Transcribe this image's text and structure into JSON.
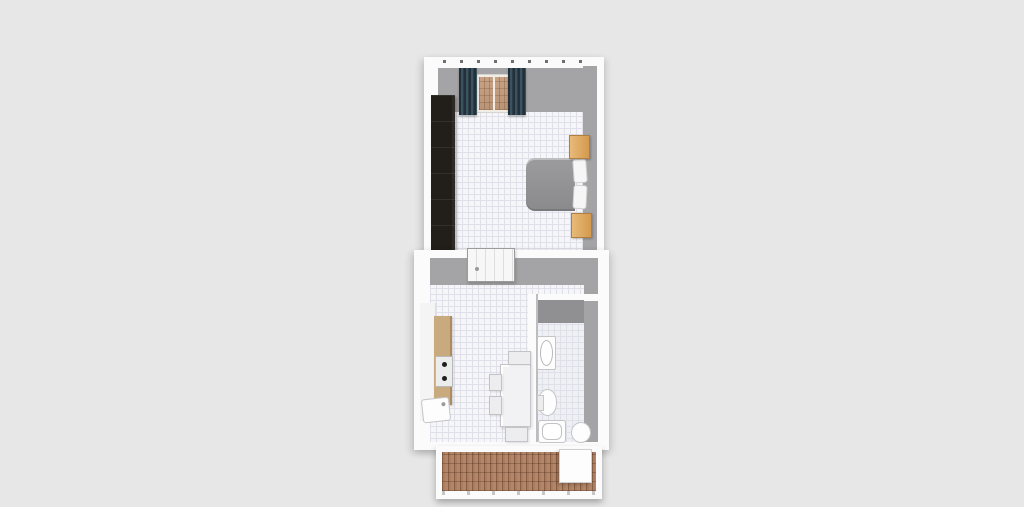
{
  "colors": {
    "background": "#e7e7e7",
    "floor_tile": "#f6f6f8",
    "tile_line": "#dfe0e9",
    "wall_white": "#fbfbfb",
    "wall_gray": "#a4a4a6",
    "bath_shadow": "#909093",
    "wardrobe": "#221e19",
    "bed_duvet": "#8a8a8c",
    "pillow": "#f6f6f6",
    "nightstand": "#d49a4f",
    "curtain": "#2f4049",
    "window_shade": "#c7a284",
    "counter_top": "#c9a97e",
    "deck_plank": "#ab7c5e",
    "fixture_white": "#fdfdfd",
    "fixture_line": "#c5c5c8"
  },
  "objects": {
    "wardrobe": "wardrobe",
    "bed": "double-bed",
    "pillow": "pillow",
    "nightstand": "nightstand",
    "curtain": "curtain",
    "window_shade": "window-shade",
    "interior_door": "interior-door",
    "kitchen_counter": "kitchen-counter",
    "cooktop": "cooktop",
    "kitchen_sink": "kitchen-sink",
    "dining_table": "dining-table",
    "chair": "chair",
    "washbasin": "washbasin",
    "toilet": "toilet",
    "bathtub": "bathtub",
    "bidet": "bidet",
    "balcony_deck": "balcony-deck",
    "balcony_table": "balcony-table"
  }
}
